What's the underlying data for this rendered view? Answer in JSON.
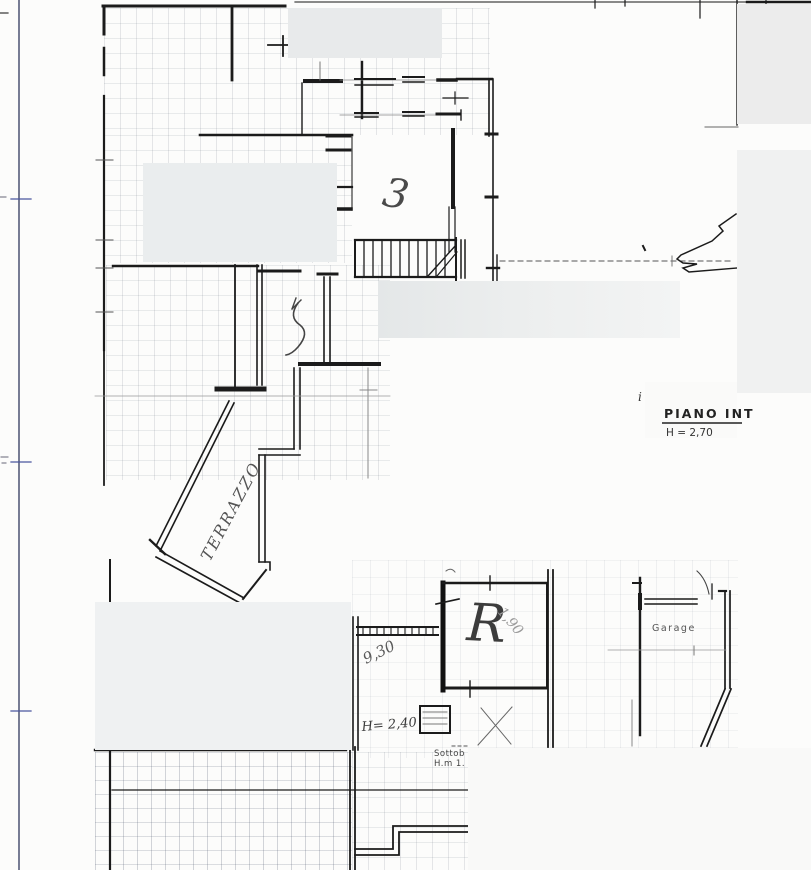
{
  "page": {
    "background": "#fcfcfb",
    "ink_color": "#1b1b1b",
    "margin_line_color": "#3f4769",
    "redaction_color": "#eaedee"
  },
  "labels": {
    "room_number": "3",
    "terrace": "TERRAZZO",
    "level_title": "PIANO INT",
    "level_height": "H = 2,70",
    "room_r": "R",
    "pencil_note": "1,90",
    "dimension": "9,30",
    "height_note": "H= 2,40",
    "basement_note_line1": "Sottob",
    "basement_note_line2": "H.m 1.",
    "garage": "Garage",
    "small_mark": "i"
  }
}
